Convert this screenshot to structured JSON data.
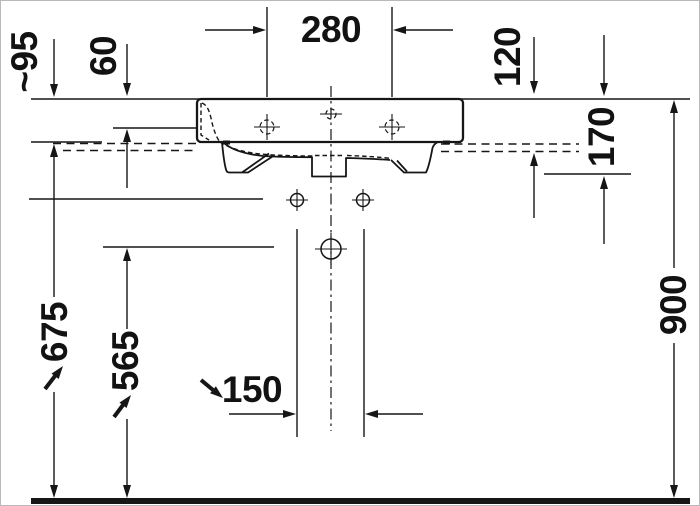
{
  "drawing": {
    "subject": "Wall-mounted washbasin technical installation drawing, front elevation",
    "units": "mm",
    "dims": {
      "tap_hole_spacing": "280",
      "front_height": "~95",
      "rim_to_tap_hole": "60",
      "rim_to_bowl_bottom": "120",
      "basin_total_height": "170",
      "fixing_holes_above_floor": "675",
      "drain_above_floor": "565",
      "fixing_hole_spacing": "150",
      "rim_above_floor": "900"
    },
    "colors": {
      "line": "#161616",
      "background": "#ffffff",
      "frame": "#b9b9b9"
    }
  }
}
